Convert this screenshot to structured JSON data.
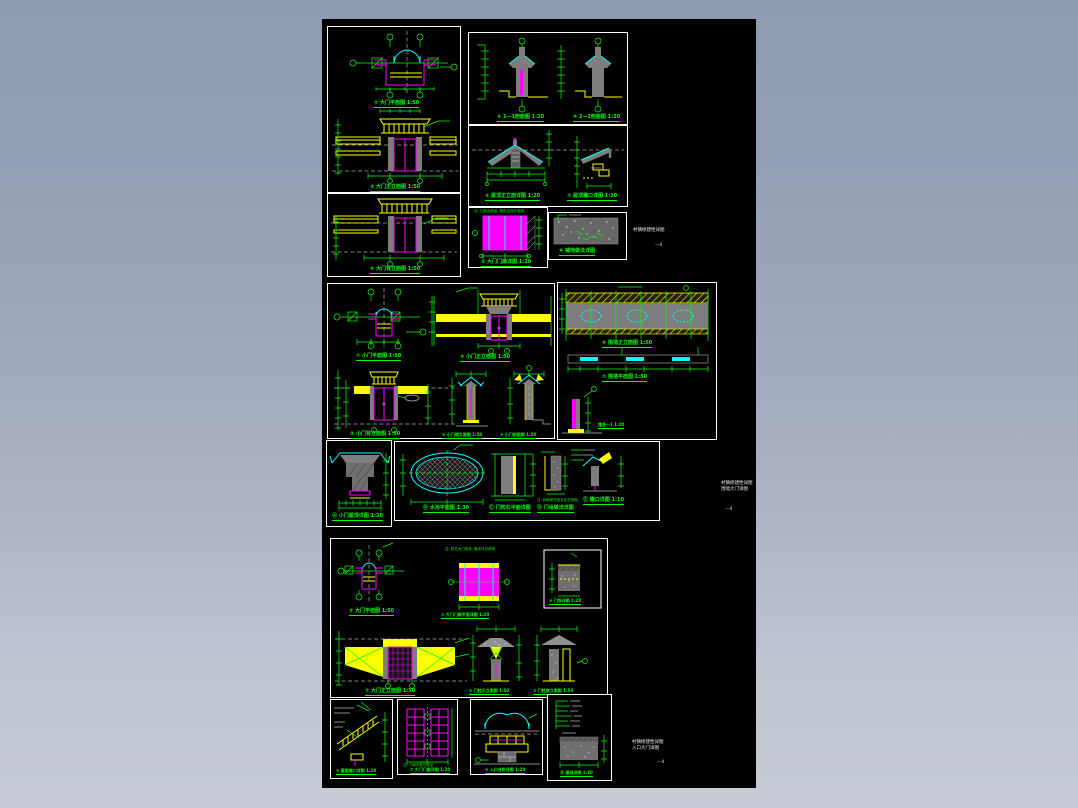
{
  "background": {
    "gradient_top": "#8f9bb1",
    "gradient_bottom": "#c6cbd6",
    "canvas": "#000000"
  },
  "palette": {
    "line_green": "#00ff00",
    "accent_yellow": "#ffff00",
    "accent_magenta": "#ff00ff",
    "accent_cyan": "#00ffff",
    "wall_gray": "#7d7d7d",
    "border_white": "#ffffff"
  },
  "captions": {
    "p1a_plan": "① 大门平面图 1:50",
    "p1a_elev": "③ 大门正立面图 1:50",
    "p1b_elev": "⑤ 大门背立面图 1:50",
    "p2a_s1": "④ 1—1剖面图 1:20",
    "p2a_s2": "⑥ 2—2剖面图 1:20",
    "p2b_roof": "⑤ 屋顶正立面详图 1:20",
    "p2b_eave": "⑦ 屋顶檐口详图 1:20",
    "p2c_note": "注: 门扇为成品, 颜色见设计说明",
    "p2c_leaf": "② 大门门扇详图 1:20",
    "p2d_pave": "⑧ 铺地做法详图",
    "p3a_plan": "① 小门平面图 1:50",
    "p3a_elev": "③ 小门正立面图 1:50",
    "p3a_back": "② 小门背立面图 1:50",
    "p3a_side1": "④ 小门侧立面图 1:50",
    "p3a_side2": "⑤ 小门剖面图 1:20",
    "p3w_elev": "⑥ 围墙正立面图 1:50",
    "p3w_plan": "⑦ 围墙平面图 1:50",
    "p3w_sec": "墙身—1 1:20",
    "p3b_roof": "Ⓐ 小门屋顶详图 1:20",
    "p4_pond": "Ⓑ 水池平面图 1:30",
    "p4_jamb": "Ⓒ 门枕石平面详图",
    "p4_note": "注: 砖砌体外贴文化石饰面",
    "p4_pier": "Ⓓ 门垛做法详图",
    "p4_eave": "Ⓔ 檐口详图 1:10",
    "p5_plan": "② 大门平面图 1:50",
    "p5_leaf_note": "注: 铁艺大门成品, 做法详见说明",
    "p5_leaf": "⑤ 大门门扇平面详图 1:20",
    "p5_block": "⑧ 门垛详图 1:20",
    "p5_elev": "① 大门正立面图 1:50",
    "p5_pier1": "④ 门柱正立面图 1:50",
    "p5_pier2": "⑤ 门柱侧立面图 1:50",
    "p6a_eave": "⑥ 屋面檐口详图 1:10",
    "p6b_note": "注: 门扇为铁艺成品",
    "p6b_leaf": "⑦ 大门门扇详图 1:20",
    "p6c_step": "⑨ 入口台阶详图 1:20",
    "p6d_found": "Ⓓ 基础详图 1:20"
  },
  "sheet_notes": [
    {
      "line1": "村镇修建性详图",
      "line2": "",
      "page": "—4"
    },
    {
      "line1": "村镇修建性详图",
      "line2": "围墙大门详图",
      "page": "—4"
    },
    {
      "line1": "村镇修建性详图",
      "line2": "入口大门详图",
      "page": "—4"
    }
  ]
}
